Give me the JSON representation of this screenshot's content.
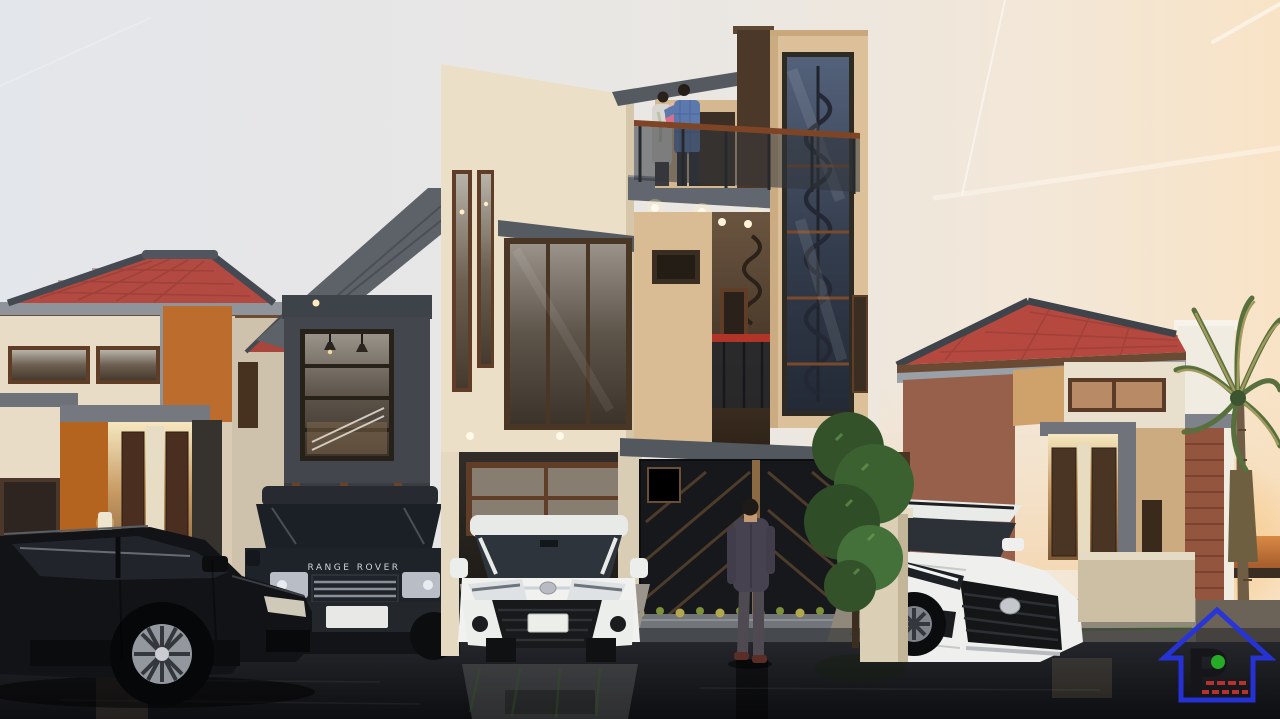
{
  "scene": {
    "type": "3D architectural exterior rendering",
    "description": "Row of modern minimalist two-to-three story houses with red tile roofs at dusk. Wet reflective street with parked cars, a couple embracing on a rooftop balcony, a man in a dark suit facing a black chevron gate, ornamental tree, and a palm tree against the sunset at far right.",
    "time_of_day": "sunset / dusk",
    "weather": "wet pavement, faint contrails in the sky"
  },
  "palette": {
    "sky_cool": "#e3e6eb",
    "sky_warm": "#f8e3c6",
    "sunset_orange": "#d88a45",
    "roof_red": "#b24a41",
    "ridge_gray": "#454a52",
    "wall_cream": "#ecdfc8",
    "wall_tan": "#d9bc95",
    "wall_orange": "#bc6c2d",
    "charcoal": "#43474d",
    "trim_gray": "#6e7278",
    "wood_frame": "#5f3d27",
    "glass_blue": "#3e4654",
    "accent_red_rail": "#b03428",
    "foliage": "#3c6130",
    "pavement": "#9b948a",
    "grass_strip": "#3f7d26",
    "asphalt": "#0d0e11"
  },
  "vehicles": {
    "black_suv": {
      "label": "black SUV in left foreground"
    },
    "range_rover": {
      "label": "dark blue-black Range Rover SUV",
      "badge": "RANGE ROVER"
    },
    "white_minivan": {
      "label": "white Toyota minivan parked in center carport"
    },
    "white_suv": {
      "label": "white Toyota SUV parked at the right house"
    }
  },
  "people": {
    "balcony_couple": "couple embracing on the rooftop balcony - woman in light cardigan, man in blue shirt",
    "suited_man": "man in a dark suit seen from behind, facing the gate"
  },
  "watermark_logo": {
    "letter": "P",
    "outline_color": "#2633de",
    "letter_color": "#16161a",
    "dot_color": "#27b327",
    "caption_color": "#c03333"
  }
}
